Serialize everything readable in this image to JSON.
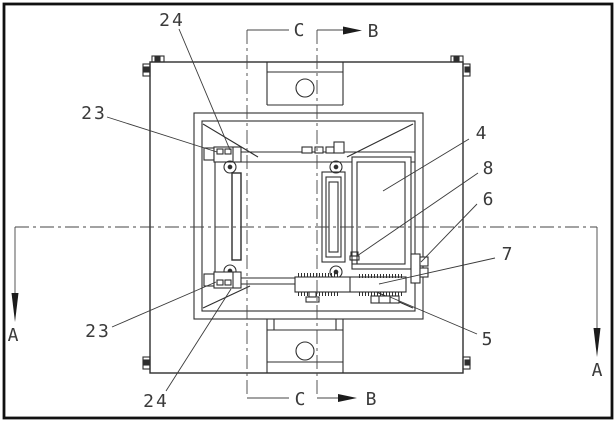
{
  "drawing": {
    "colors": {
      "line": "#2e2e2e",
      "text": "#3a3a3a",
      "background": "#ffffff"
    },
    "labels": {
      "ref_24_top": "24",
      "ref_23_top": "23",
      "ref_23_bottom": "23",
      "ref_24_bottom": "24",
      "ref_4": "4",
      "ref_8": "8",
      "ref_6": "6",
      "ref_7": "7",
      "ref_5": "5",
      "section_b_top": "B",
      "section_b_bottom": "B",
      "section_c_top": "C",
      "section_c_bottom": "C",
      "section_a_left": "A",
      "section_a_right": "A"
    }
  }
}
